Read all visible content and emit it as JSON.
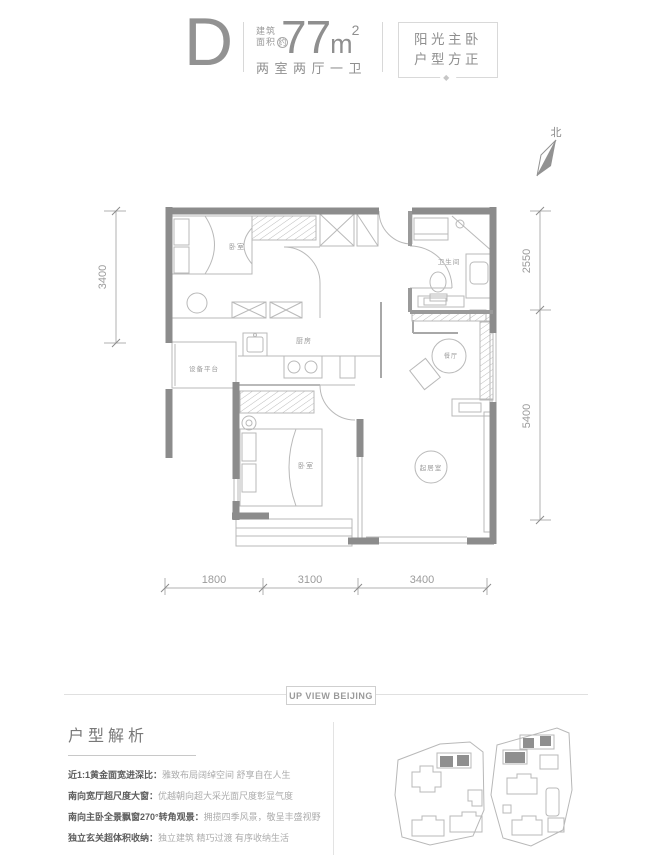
{
  "header": {
    "unit_type": "D",
    "area_prefix_line1": "建筑",
    "area_prefix_line2": "面积",
    "area_approx": "约",
    "area_value": "77",
    "area_unit": "m",
    "area_exponent": "2",
    "layout_summary": "两室两厅一卫",
    "tagline_line1": "阳光主卧",
    "tagline_line2": "户型方正",
    "tag_ornament": "◆"
  },
  "compass": {
    "north": "北"
  },
  "floorplan": {
    "rooms": {
      "bedroom_top": "卧室",
      "bedroom_bottom": "卧室",
      "kitchen": "厨房",
      "bathroom": "卫生间",
      "dining": "餐厅",
      "living": "起居室",
      "equipment_platform": "设备平台"
    },
    "dimensions": {
      "left_height": "3400",
      "right_top_height": "2550",
      "right_bottom_height": "5400",
      "bottom_left_width": "1800",
      "bottom_middle_width": "3100",
      "bottom_right_width": "3400"
    }
  },
  "divider": {
    "badge": "UP VIEW BEIJING"
  },
  "analysis": {
    "title": "户型解析",
    "points": [
      {
        "label": "近1:1黄金面宽进深比：",
        "text": "雅致布局阔绰空间 舒享自在人生"
      },
      {
        "label": "南向宽厅超尺度大窗：",
        "text": "优越朝向超大采光面尺度彰显气度"
      },
      {
        "label": "南向主卧全景飘窗270°转角观景：",
        "text": "拥揽四季风景，敬呈丰盛视野"
      },
      {
        "label": "独立玄关超体积收纳：",
        "text": "独立建筑 精巧过渡 有序收纳生活"
      }
    ]
  },
  "colors": {
    "wall": "#8c8c8c",
    "primary_text": "#8f8f8f",
    "light_line": "#b9b9b9"
  }
}
